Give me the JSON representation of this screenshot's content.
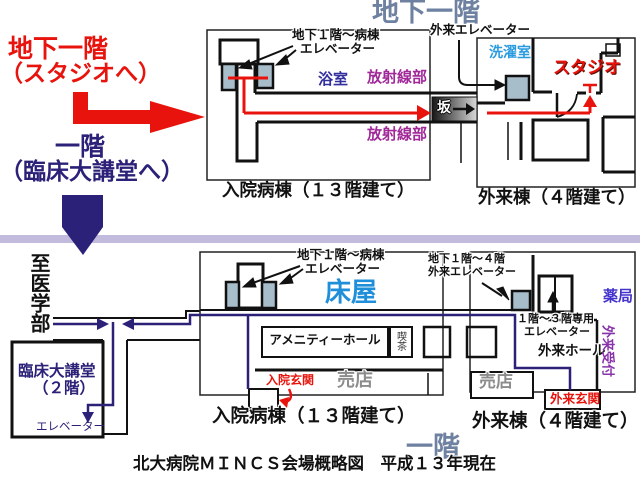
{
  "headers": {
    "basement_floor": "地下一階",
    "first_floor": "一階",
    "caption": "北大病院ＭＩＮＣＳ会場概略図　平成１３年現在"
  },
  "legend": {
    "b1_line1": "地下一階",
    "b1_line2": "（スタジオへ）",
    "f1_line1": "一階",
    "f1_line2": "（臨床大講堂へ）"
  },
  "b1_map": {
    "inpatient": {
      "elevator_label_line1": "地下１階～病棟",
      "elevator_label_line2": "エレベーター",
      "bath": "浴室",
      "radiology_upper": "放射線部",
      "radiology_lower": "放射線部",
      "name": "入院病棟（１３階建て）"
    },
    "outpatient": {
      "elevator_label": "外来エレベーター",
      "laundry": "洗濯室",
      "studio": "スタジオ",
      "slope": "坂",
      "name": "外来棟（４階建て）"
    }
  },
  "f1_map": {
    "to_medical_school": "至医学部",
    "lecture_hall": {
      "name_line1": "臨床大講堂",
      "name_line2": "（２階）",
      "elevator": "エレベーター"
    },
    "inpatient": {
      "elevator_label_line1": "地下１階～病棟",
      "elevator_label_line2": "エレベーター",
      "barber": "床屋",
      "amenity_hall": "アメニティーホール",
      "cafe": "喫茶",
      "entrance": "入院玄関",
      "shop": "売店",
      "name": "入院病棟（１３階建て）"
    },
    "outpatient": {
      "elevator_label_line1": "地下１階～４階",
      "elevator_label_line2": "外来エレベーター",
      "elevator2_label_line1": "１階～３階専用",
      "elevator2_label_line2": "エレベーター",
      "hall": "外来ホール",
      "pharmacy": "薬局",
      "reception": "外来受付",
      "shop": "売店",
      "entrance": "外来玄関",
      "name": "外来棟（４階建て）"
    }
  },
  "colors": {
    "accent_red": "#e8130c",
    "route_navy": "#2b2178",
    "floor_header_slate": "#6e81a0",
    "divider_lavender": "#c3bbdd",
    "elevator_gray": "#a7bdca",
    "radiology_magenta": "#a02898",
    "laundry_blue": "#2b9be0",
    "bath_blue": "#332e9e",
    "barber_blue": "#1e8fd8",
    "pharmacy_indigo": "#4433cc",
    "reception_purple": "#8833aa",
    "shop_gray": "#8c8c8c"
  }
}
